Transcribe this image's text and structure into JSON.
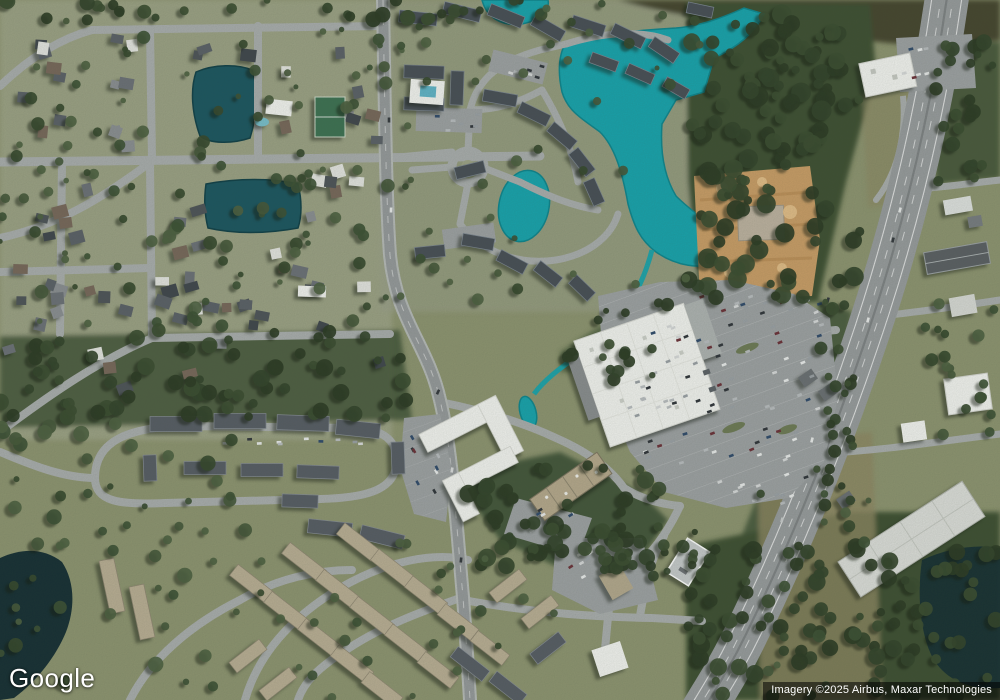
{
  "map": {
    "view_type": "satellite",
    "logo": "Google",
    "attribution": "Imagery ©2025 Airbus, Maxar Technologies"
  },
  "palette": {
    "land": "#8d9470",
    "suburb": "#9da387",
    "forest": "#3c4f33",
    "marsh": "#45452e",
    "dry": "#8d8763",
    "water_dark": "#1a5560",
    "water_teal": "#16a3ad",
    "water_black": "#152e33",
    "road": "#a9adad",
    "road_major": "#95999b",
    "road_casing": "#b6bab8",
    "highway": "#979b9d",
    "parking": "#9da1a3",
    "roof_white": "#f3f4f1",
    "roof_dark": "#4a5158",
    "roof_tan": "#b9ae94",
    "dirt": "#c99d66",
    "dirt_light": "#e2bd87",
    "attr_bg": "rgba(0,0,0,0.55)",
    "attr_fg": "#ffffff"
  }
}
